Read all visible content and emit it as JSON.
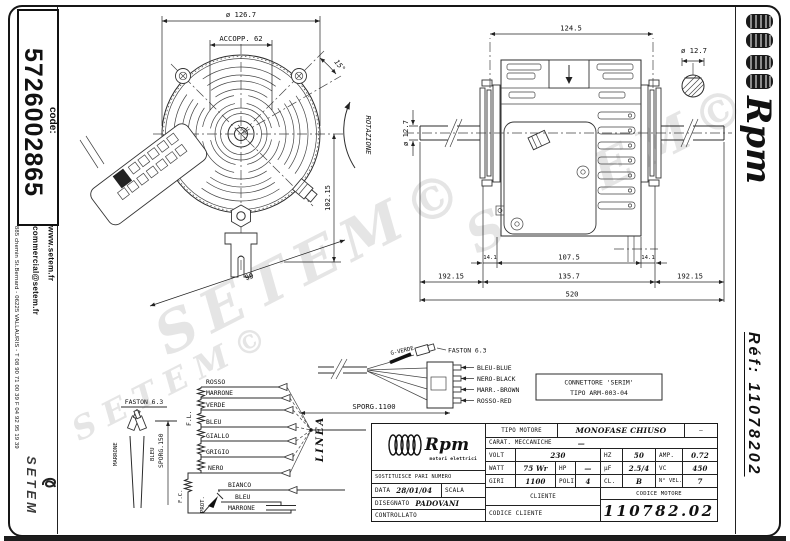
{
  "page": {
    "watermark": "SETEM©"
  },
  "sidebar_left": {
    "code_label": "code:",
    "code_value": "5726002865",
    "website": "www.setem.fr",
    "email": "commercial@setem.fr",
    "address": "885 chemin St.Bernard - 06225 VALLAURIS - T 08 90 71 00 39 F 04 92 95 19 39",
    "brand": "SETEM"
  },
  "sidebar_right": {
    "brand": "Rpm",
    "ref": "Réf: 11078202"
  },
  "front_view": {
    "dim_diameter": "ø 126.7",
    "dim_coupling": "ACCOPP. 62",
    "dim_angle": "15°",
    "rotation_label": "ROTAZIONE",
    "dim_height": "102.15",
    "dim_width": "99"
  },
  "side_view": {
    "dim_top": "124.5",
    "dim_shaft_detail": "ø 12.7",
    "dim_shaft": "ø 12.7",
    "dim_hub_left": "14.1",
    "dim_body": "107.5",
    "dim_hub_right": "14.1",
    "dim_shaft_left": "192.15",
    "dim_center": "135.7",
    "dim_shaft_right": "192.15",
    "dim_total": "520"
  },
  "wiring": {
    "faston_label": "FASTON 6.3",
    "faston_wires": [
      "MARRONE",
      "BLEU"
    ],
    "sporg_left": "SPORG.150",
    "fl": "F.L.",
    "fc": "F.C.",
    "prot": "PROT.",
    "linea": "LINEA",
    "wires": [
      "ROSSO",
      "MARRONE",
      "VERDE",
      "BLEU",
      "GIALLO",
      "GRIGIO",
      "NERO",
      "BIANCO",
      "BLEU",
      "MARRONE"
    ],
    "sporg_cable": "SPORG.1100",
    "earth_wire": "G-VERDE",
    "connector_wires": [
      "BLEU-BLUE",
      "NERO-BLACK",
      "MARR.-BROWN",
      "ROSSO-RED"
    ],
    "connector_note1": "CONNETTORE 'SERIM'",
    "connector_note2": "TIPO ARM-003-04"
  },
  "table": {
    "brand": "Rpm",
    "brand_sub": "motori elettrici",
    "sostituisce": "SOSTITUISCE PARI NUMERO",
    "data_label": "DATA",
    "data_value": "28/01/04",
    "scala_label": "SCALA",
    "disegnato_label": "DISEGNATO",
    "disegnato_value": "PADOVANI",
    "controllato_label": "CONTROLLATO",
    "tipo_label": "TIPO MOTORE",
    "tipo_value": "MONOFASE CHIUSO",
    "tipo_extra": "—",
    "carat_label": "CARAT. MECCANICHE",
    "carat_value": "—",
    "volt_label": "VOLT",
    "volt_value": "230",
    "hz_label": "HZ",
    "hz_value": "50",
    "amp_label": "AMP.",
    "amp_value": "0.72",
    "watt_label": "WATT",
    "watt_value": "75 Wr",
    "hp_label": "HP",
    "hp_value": "—",
    "uf_label": "µF",
    "uf_value": "2.5/4",
    "vc_label": "VC",
    "vc_value": "450",
    "giri_label": "GIRI",
    "giri_value": "1100",
    "poli_label": "POLI",
    "poli_value": "4",
    "cl_label": "CL.",
    "cl_value": "B",
    "nvel_label": "N° VEL.",
    "nvel_value": "7",
    "cliente_label": "CLIENTE",
    "codice_cliente_label": "CODICE CLIENTE",
    "codice_motore_label": "CODICE MOTORE",
    "codice_motore_value": "110782.02"
  }
}
